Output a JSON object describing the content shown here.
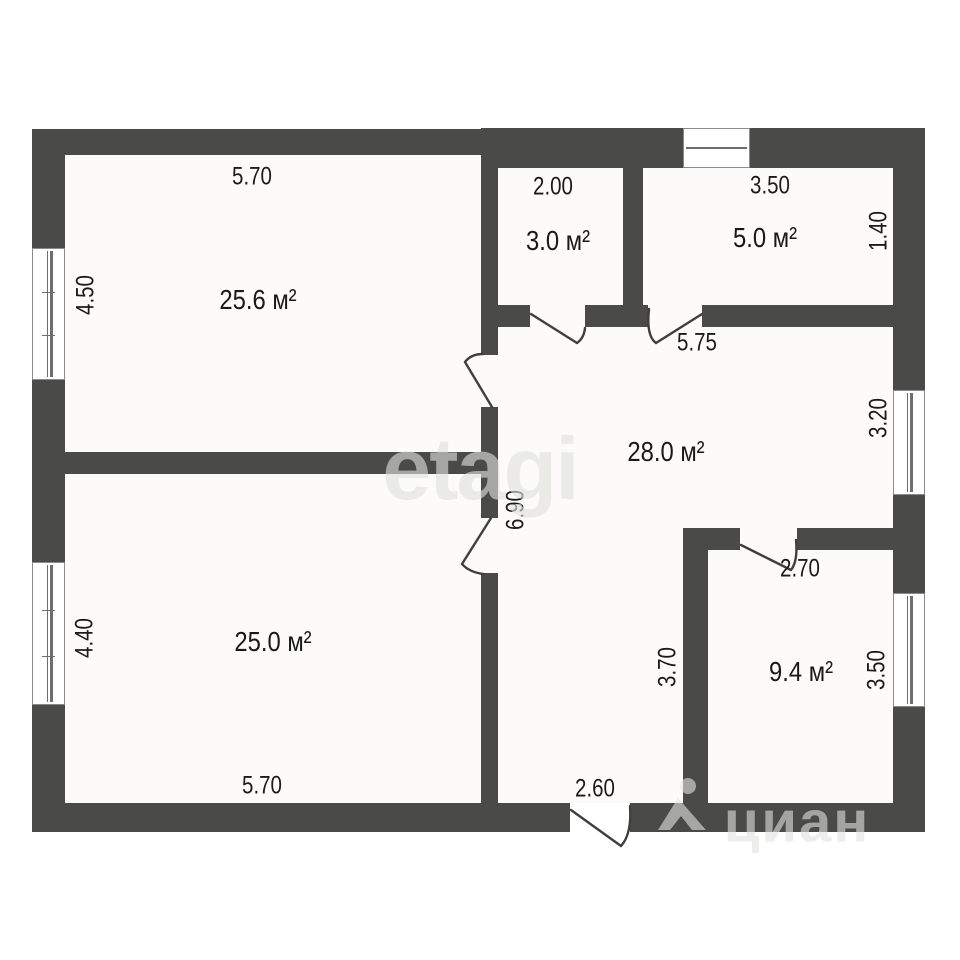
{
  "plan_type": "floor-plan",
  "rooms": [
    {
      "id": "room-25-6",
      "area": "25.6 м²"
    },
    {
      "id": "room-3-0",
      "area": "3.0 м²"
    },
    {
      "id": "room-5-0",
      "area": "5.0 м²"
    },
    {
      "id": "hall-28-0",
      "area": "28.0 м²"
    },
    {
      "id": "room-25-0",
      "area": "25.0 м²"
    },
    {
      "id": "room-9-4",
      "area": "9.4 м²"
    }
  ],
  "dimensions": {
    "top_width_room1": "5.70",
    "left_height_room1": "4.50",
    "width_room_3_0": "2.00",
    "width_room_5_0": "3.50",
    "right_height_room_5_0": "1.40",
    "hall_top_width": "5.75",
    "hall_window_height": "3.20",
    "hall_height": "6.90",
    "door_room_9_4": "2.70",
    "left_height_room_9_4": "3.70",
    "window_height_room_9_4": "3.50",
    "left_height_room2": "4.40",
    "bottom_width_room2": "5.70",
    "entry_door_width": "2.60"
  },
  "watermarks": {
    "etagi": "etagi",
    "cian": "циан"
  },
  "colors": {
    "wall": "#4a4a48",
    "background": "#ffffff",
    "label_text": "#1b1b1b",
    "watermark": "#e3e3e2"
  }
}
